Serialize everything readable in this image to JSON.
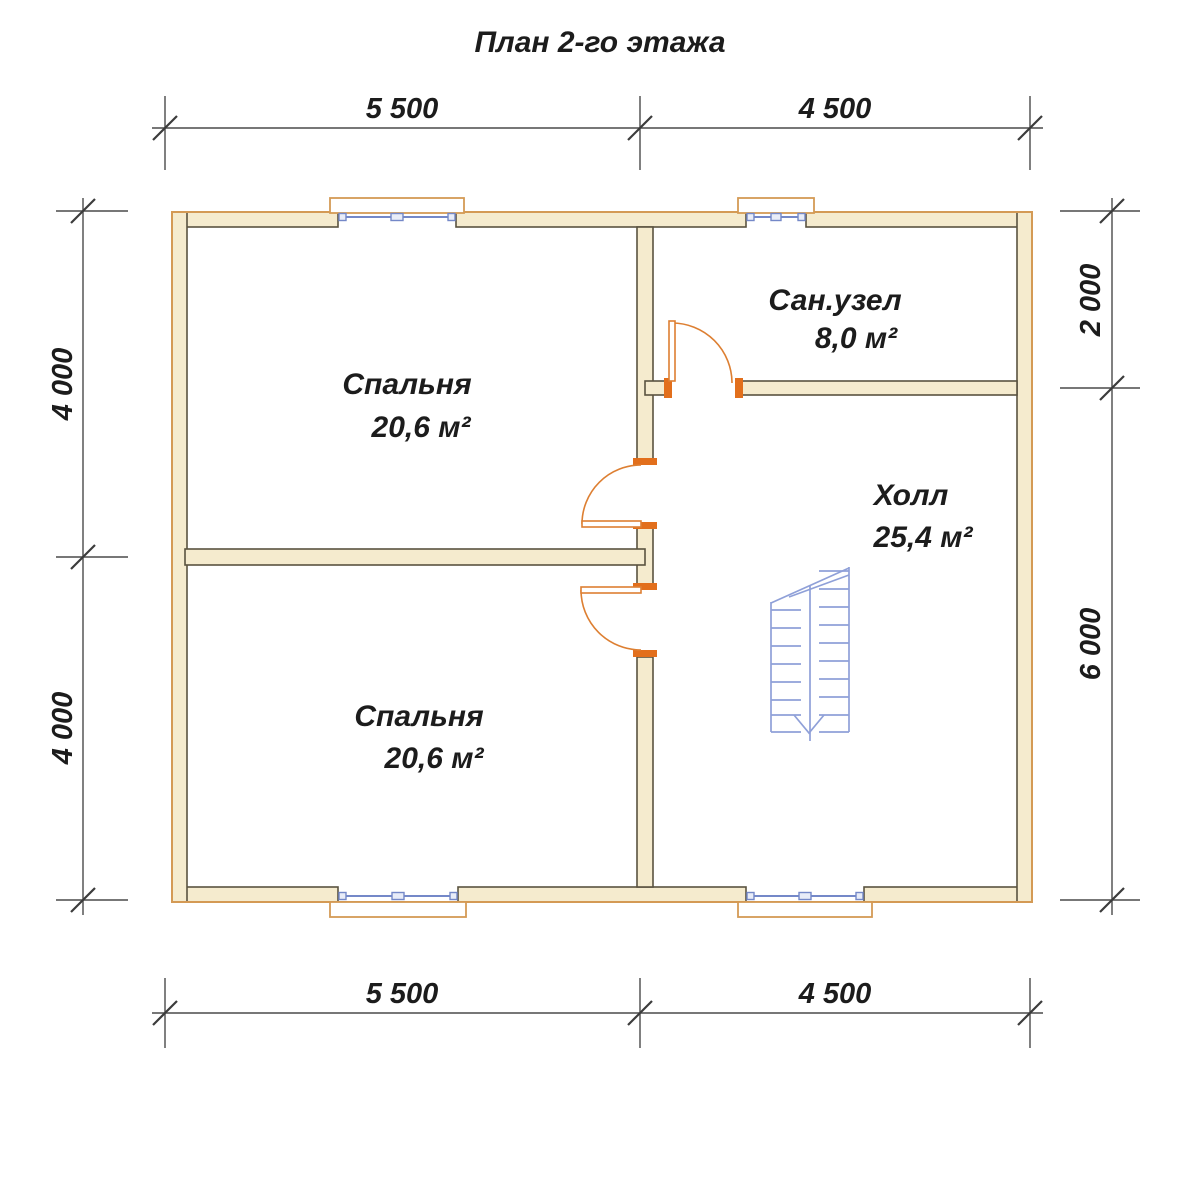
{
  "title": "План 2-го этажа",
  "rooms": [
    {
      "name": "Спальня",
      "area": "20,6 м²"
    },
    {
      "name": "Сан.узел",
      "area": "8,0 м²"
    },
    {
      "name": "Холл",
      "area": "25,4 м²"
    },
    {
      "name": "Спальня",
      "area": "20,6 м²"
    }
  ],
  "dimensions": {
    "top": [
      "5 500",
      "4 500"
    ],
    "bottom": [
      "5 500",
      "4 500"
    ],
    "left": [
      "4 000",
      "4 000"
    ],
    "right": [
      "2 000",
      "6 000"
    ]
  },
  "colors": {
    "background": "#ffffff",
    "wall_fill": "#f5ebce",
    "wall_edge": "#5a5340",
    "exterior_outline": "#d49a55",
    "door_orange": "#dd7f32",
    "jamb_orange": "#e26f1c",
    "window_blue": "#7488c8",
    "stair_blue": "#8fa0d8",
    "dimension_line": "#4a4a4a",
    "text": "#1c1c1c"
  }
}
